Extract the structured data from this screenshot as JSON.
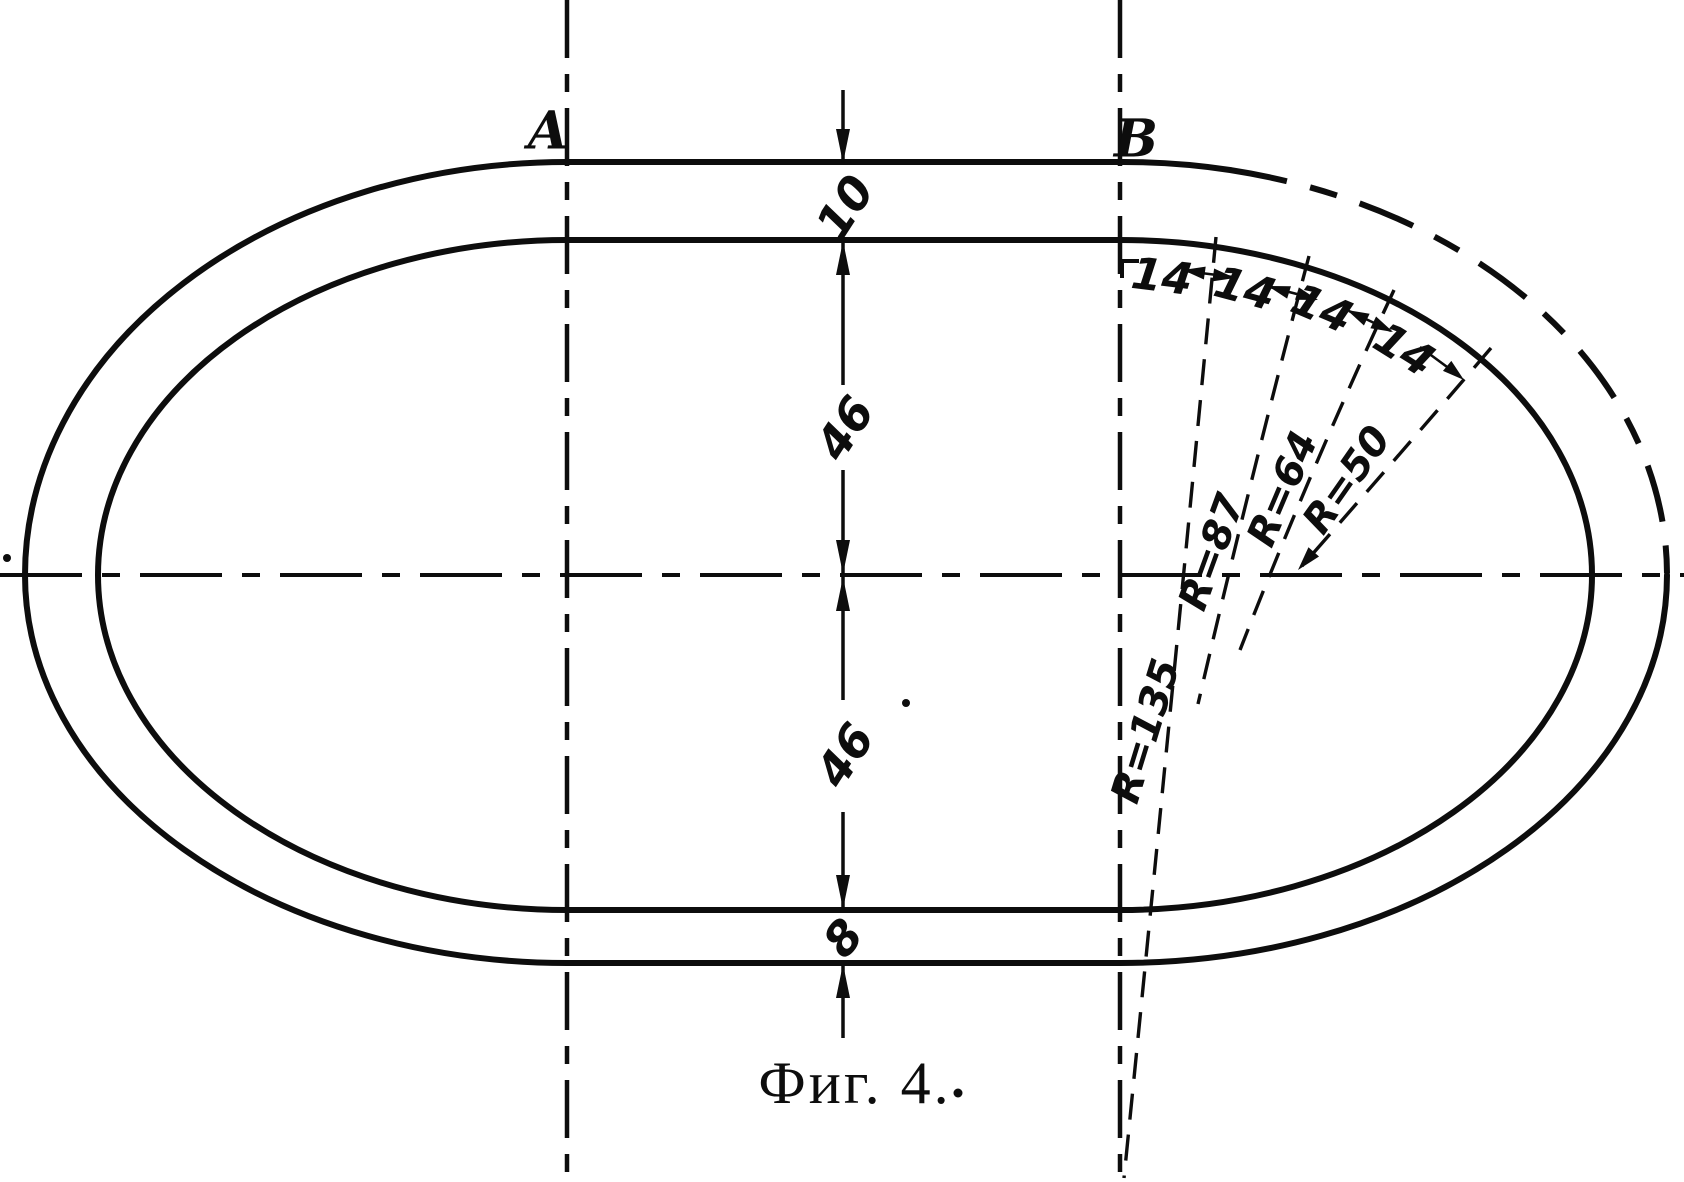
{
  "figure": {
    "caption": "Фиг. 4.",
    "ink_color": "#0d0d0d",
    "paper_color": "#ffffff"
  },
  "tangent_labels": {
    "left": "A",
    "right": "B"
  },
  "dimensions": {
    "track_width_top": "10",
    "half_height_upper": "46",
    "half_height_lower": "46",
    "track_width_bottom": "8"
  },
  "arc_segments": {
    "labels": [
      "14",
      "14",
      "14",
      "14"
    ]
  },
  "radii": {
    "labels": [
      "R=135",
      "R=87",
      "R=64",
      "R=50"
    ]
  }
}
